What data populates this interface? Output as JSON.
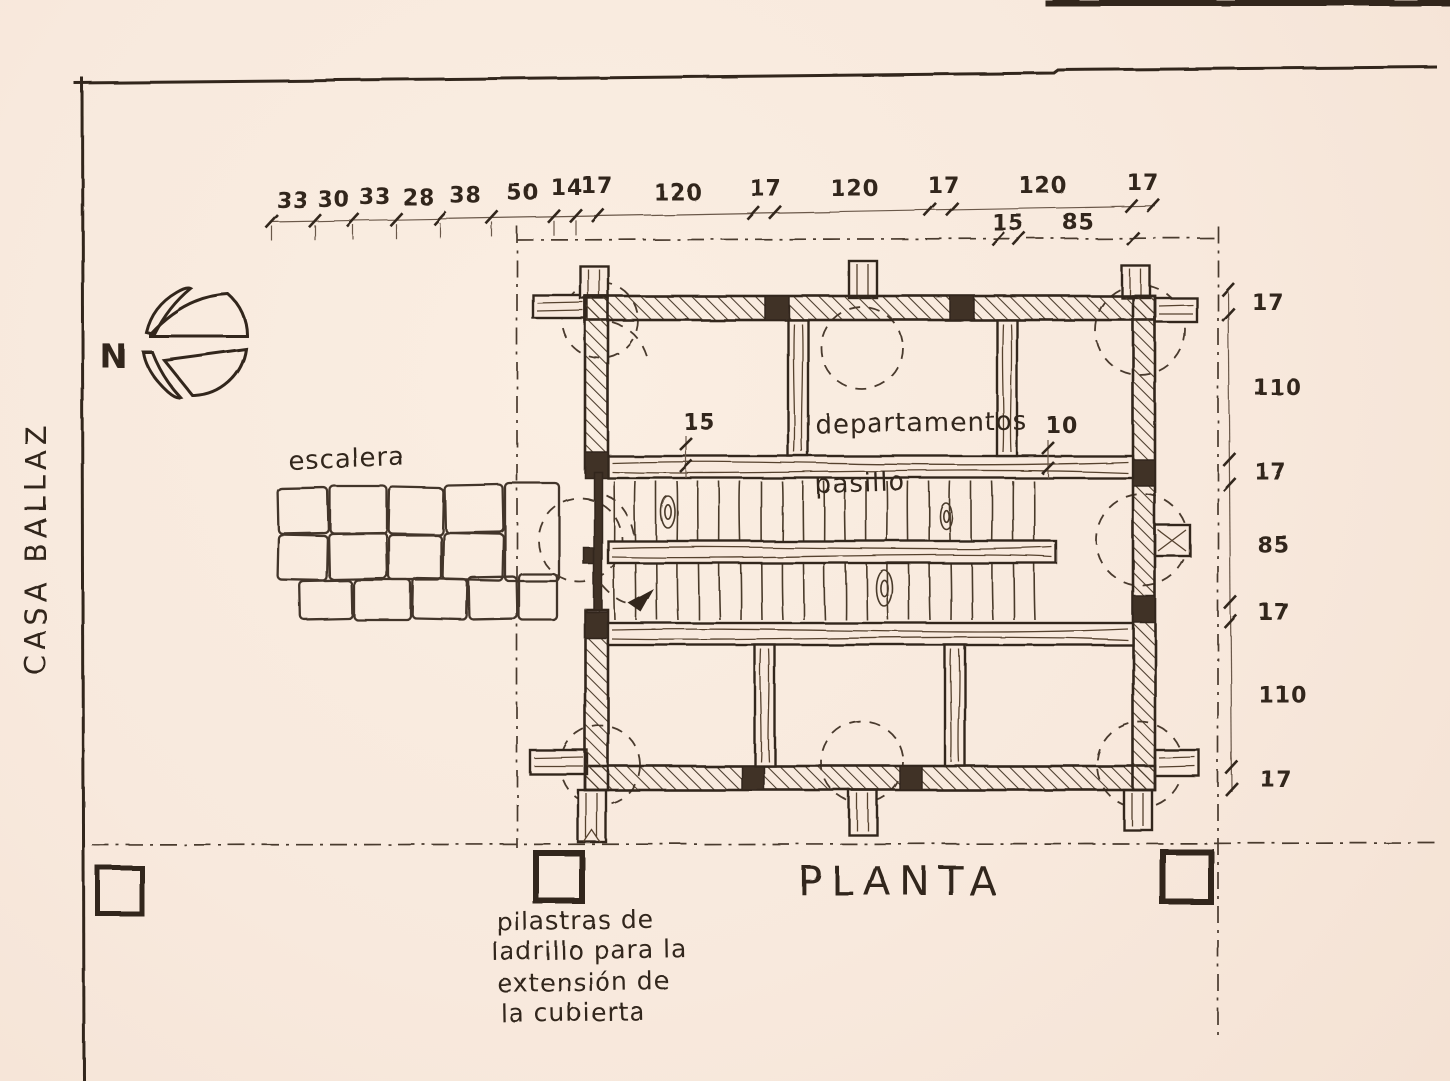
{
  "title": "PLANTA",
  "project": "CASA BALLAZ",
  "compass": {
    "north_label": "N"
  },
  "labels": {
    "stairs": "escalera",
    "rooms": "departamentos",
    "corridor": "pasillo",
    "pilasters_note_lines": [
      "pilastras de",
      "ladrillo para la",
      "extensión de",
      "la cubierta"
    ]
  },
  "dimensions": {
    "top_chain": [
      "33",
      "30",
      "33",
      "28",
      "38",
      "50",
      "14",
      "17",
      "120",
      "17",
      "120",
      "17",
      "120",
      "17"
    ],
    "top_sub_chain": [
      "15",
      "85"
    ],
    "right_chain": [
      "17",
      "110",
      "17",
      "85",
      "17",
      "110",
      "17"
    ],
    "interior": {
      "beam_left": "15",
      "beam_right": "10"
    }
  },
  "colors": {
    "paper": "#f8e9dd",
    "ink": "#33281e"
  }
}
